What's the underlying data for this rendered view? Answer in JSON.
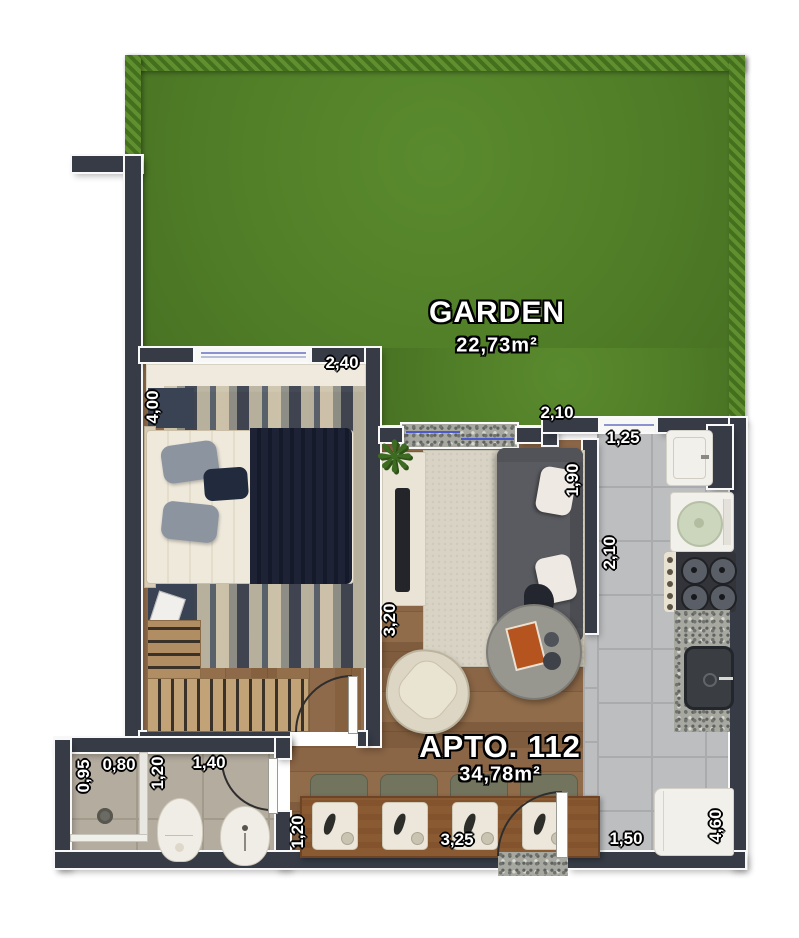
{
  "garden": {
    "label": "GARDEN",
    "area": "22,73m²"
  },
  "apartment": {
    "label": "APTO. 112",
    "area": "34,78m²"
  },
  "dims": {
    "bedroom_width": "2,40",
    "bedroom_length": "4,00",
    "terrace_gap": "2,10",
    "kitchen_top": "1,25",
    "kitchen_entry": "1,90",
    "kitchen_length": "2,10",
    "living_length": "3,20",
    "shower_depth": "0,95",
    "shower_width": "0,80",
    "wc_depth": "1,20",
    "wc_width": "1,40",
    "dining_depth": "1,20",
    "dining_width": "3,25",
    "kitchen_width": "1,50",
    "apto_length": "4,60"
  },
  "icons": {
    "plant": "❋"
  },
  "colors": {
    "wall": "#363b46",
    "grass": "#517f28",
    "hedge": "#4a7421",
    "wood": "#8a6546",
    "kitchen_tile": "#bcbec0",
    "bath_tile": "#b4ac9e",
    "glass": "#4b5bc9",
    "sofa": "#595b60",
    "table_wood": "#8a5a33",
    "label_text": "#ffffff"
  }
}
